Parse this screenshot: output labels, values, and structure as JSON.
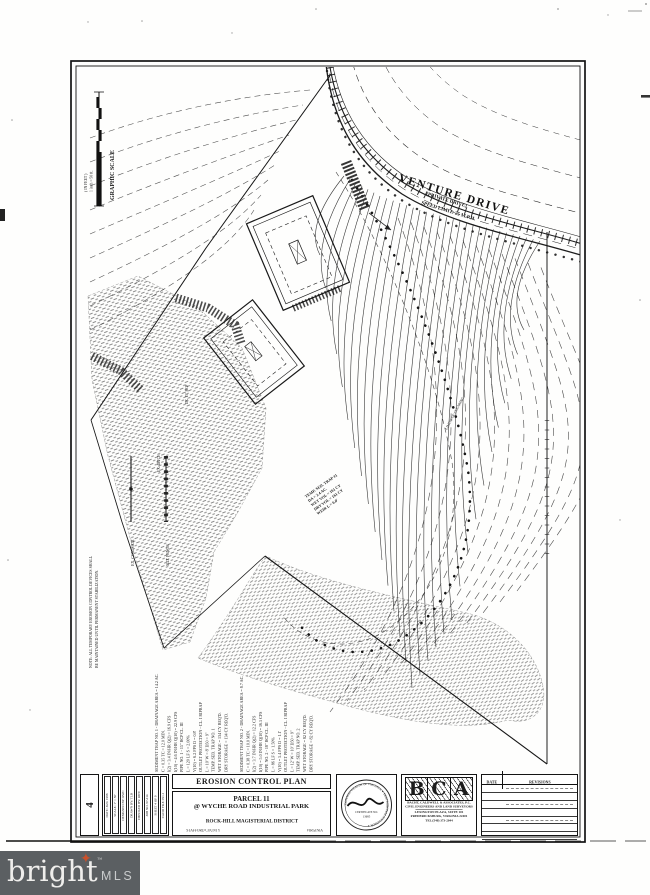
{
  "colors": {
    "ink": "#1b1b1b",
    "paper": "#ffffff",
    "watermark_bar": "#5b5f62",
    "watermark_star": "#c8502b"
  },
  "watermark": {
    "brand": "bright",
    "tm": "™",
    "suffix": "MLS"
  },
  "scale": {
    "title": "GRAPHIC SCALE",
    "feet": "( IN FEET )",
    "ratio": "1 inch = 50 ft."
  },
  "road": {
    "name": "VENTURE DRIVE",
    "sub1": "(PRIVATE DRIVE)",
    "sub2": "SPEED LIMIT: 25 M.P.H."
  },
  "legend": {
    "item1": "EX. CONTOUR",
    "item2": "SILT FENCE"
  },
  "field_note": {
    "line1": "NOTE: ALL TEMPORARY EROSION CONTROL DEVICES SHALL",
    "line2": "BE MAINTAINED UNTIL PERMANENT STABILIZATION."
  },
  "field_labels": [
    "EX. 15\" RCP",
    "EX. DITCH",
    "LIMITS OF CLEARING"
  ],
  "trap_lines": [
    "TEMP. SED. TRAP #1",
    "DA = 2.4 AC.",
    "WET VOL = 161 CY",
    "DRY VOL = 161 CY",
    "WEIR L = 6.0'"
  ],
  "calc_a": [
    "SEDIMENT TRAP NO. 1  -  DRAINAGE AREA = 14.2 AC.",
    "C = 0.35    TC = 12.0 MIN.",
    "I(2) = 3.4 IN/HR    Q(2) = 16.9 CFS",
    "I(10) = 4.6 IN/HR   Q(10) = 22.9 CFS",
    "PIPE NO. 1 - 15\" RCP CL. III",
    "L = 120 LF    S = 2.00%",
    "V(10) = 6.2 FPS    D = 0.8'",
    "OUTLET PROTECTION - CL. I RIPRAP",
    "L = 10'   W = 8'   D50 = 9\"",
    "TEMP. SED. TRAP NO. 1",
    "WET STORAGE = 134 CY REQ'D.",
    "DRY STORAGE = 134 CY REQ'D."
  ],
  "calc_b": [
    "SEDIMENT TRAP NO. 2  -  DRAINAGE AREA = 8.7 AC.",
    "C = 0.38    TC = 10.0 MIN.",
    "I(2) = 3.7 IN/HR    Q(2) = 12.2 CFS",
    "I(10) = 5.0 IN/HR   Q(10) = 16.5 CFS",
    "PIPE NO. 2 - 18\" RCP CL. III",
    "L = 86 LF    S = 1.50%",
    "V(10) = 5.4 FPS    D = 1.1'",
    "OUTLET PROTECTION - CL. I RIPRAP",
    "L = 12'   W = 10'   D50 = 9\"",
    "TEMP. SED. TRAP NO. 2",
    "WET STORAGE = 82 CY REQ'D.",
    "DRY STORAGE = 82 CY REQ'D."
  ],
  "titleblock": {
    "sheet_no": "4",
    "strips": [
      "DATE: JAN. 1998",
      "SCALE: 1\" = 50'",
      "DESIGNED BY: RWC",
      "DRAWN BY: TLB",
      "CHECKED BY: RWC",
      "JOB NO. 97-214",
      "SHEET 4 OF 9",
      "CADD FILE: EC-1"
    ],
    "plan_title": "EROSION CONTROL PLAN",
    "parcel": "PARCEL 11",
    "subtitle": "@ WYCHE ROAD INDUSTRIAL PARK",
    "district": "ROCK-HILL MAGISTERIAL DISTRICT",
    "county": "STAFFORD COUNTY",
    "state": "VIRGINIA",
    "firm": {
      "l1": "B",
      "l2": "C",
      "l3": "A",
      "name": "BACHT, CALDWELL & ASSOCIATES, P.C.",
      "line2": "CIVIL ENGINEERS AND LAND SURVEYORS",
      "line3": "LEXINGTON PLAZA, SUITE 101",
      "line4": "FREDERICKSBURG, VIRGINIA 22401",
      "line5": "TEL (540) 373-2044"
    },
    "seal": {
      "ring": "COMMONWEALTH OF VIRGINIA ✦ PROFESSIONAL ENGINEER ✦",
      "cert": "CERTIFICATE NO.",
      "no": "13685"
    },
    "rev": {
      "date": "DATE",
      "revisions": "REVISIONS"
    }
  }
}
